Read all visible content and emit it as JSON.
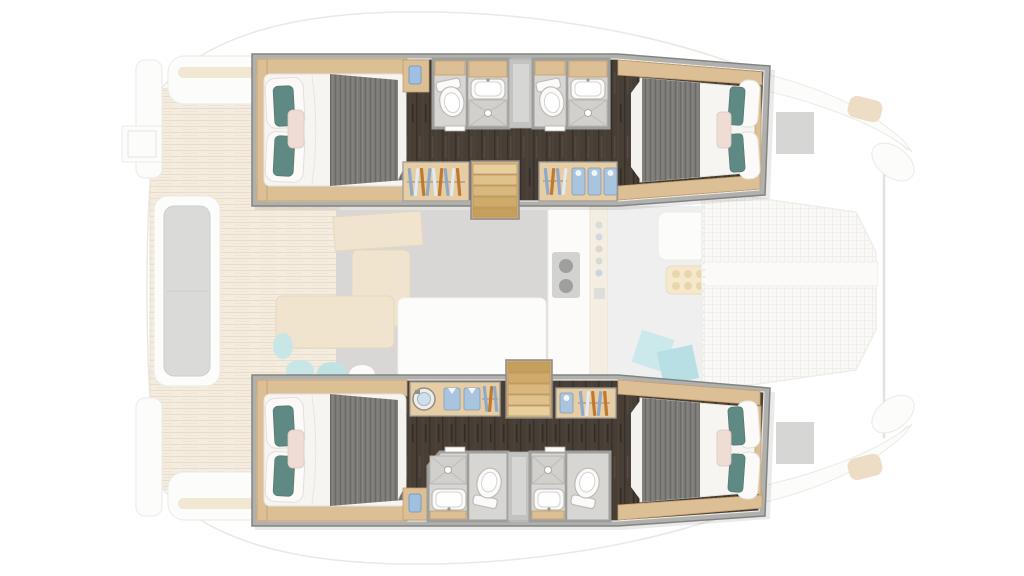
{
  "meta": {
    "description": "Top-down deck plan of a sailing catamaran: four lower-deck double cabins with en-suite bathrooms, wardrobes and companionway stairs are highlighted in full colour inside the two hulls, drawn over a faded main-deck plan showing saloon, galley, chart table, aft cockpit, swim platforms and the bow trampoline."
  },
  "colors": {
    "frame_gray": "#b0b0ae",
    "floor_dark": "#473e36",
    "wood": "#dcbf94",
    "wood_edge": "#c39e6c",
    "wood_light": "#e6cda3",
    "stair_wood": "#d9b67e",
    "duvet_white": "#f6f5f2",
    "blanket_gray": "#7b7975",
    "pillow_teal": "#5f8a84",
    "pillow_blush": "#eedcd5",
    "accent_blue": "#9fc0e0",
    "folded_blue": "#a9c4de",
    "hanger_blue": "#8fa9c9",
    "hanger_orange": "#c07a30",
    "bath_floor": "#d8d6d2",
    "bath_wall": "#9e9e9c",
    "shower_floor": "#d2d0cc",
    "teak": "#f2e9da",
    "teak_line": "#e5d8c2",
    "rug_gray": "#d2d1cf",
    "bench_gray": "#d4d4d2",
    "sunpad_gray": "#d0d0ce",
    "salon_teal": "#bfe2e2",
    "net": "#faf9f6",
    "net_line": "#edebe6"
  },
  "inventory": {
    "hulls": 2,
    "cabins": 4,
    "double_beds": 4,
    "bathrooms": 4,
    "toilets": 4,
    "showers": 4,
    "sinks": 4,
    "wardrobes": 4,
    "companionway_stairs": 2,
    "washing_machine": 1,
    "trampoline": 1,
    "cockpit_benches": 2,
    "galley": 1,
    "dinette": 1
  }
}
